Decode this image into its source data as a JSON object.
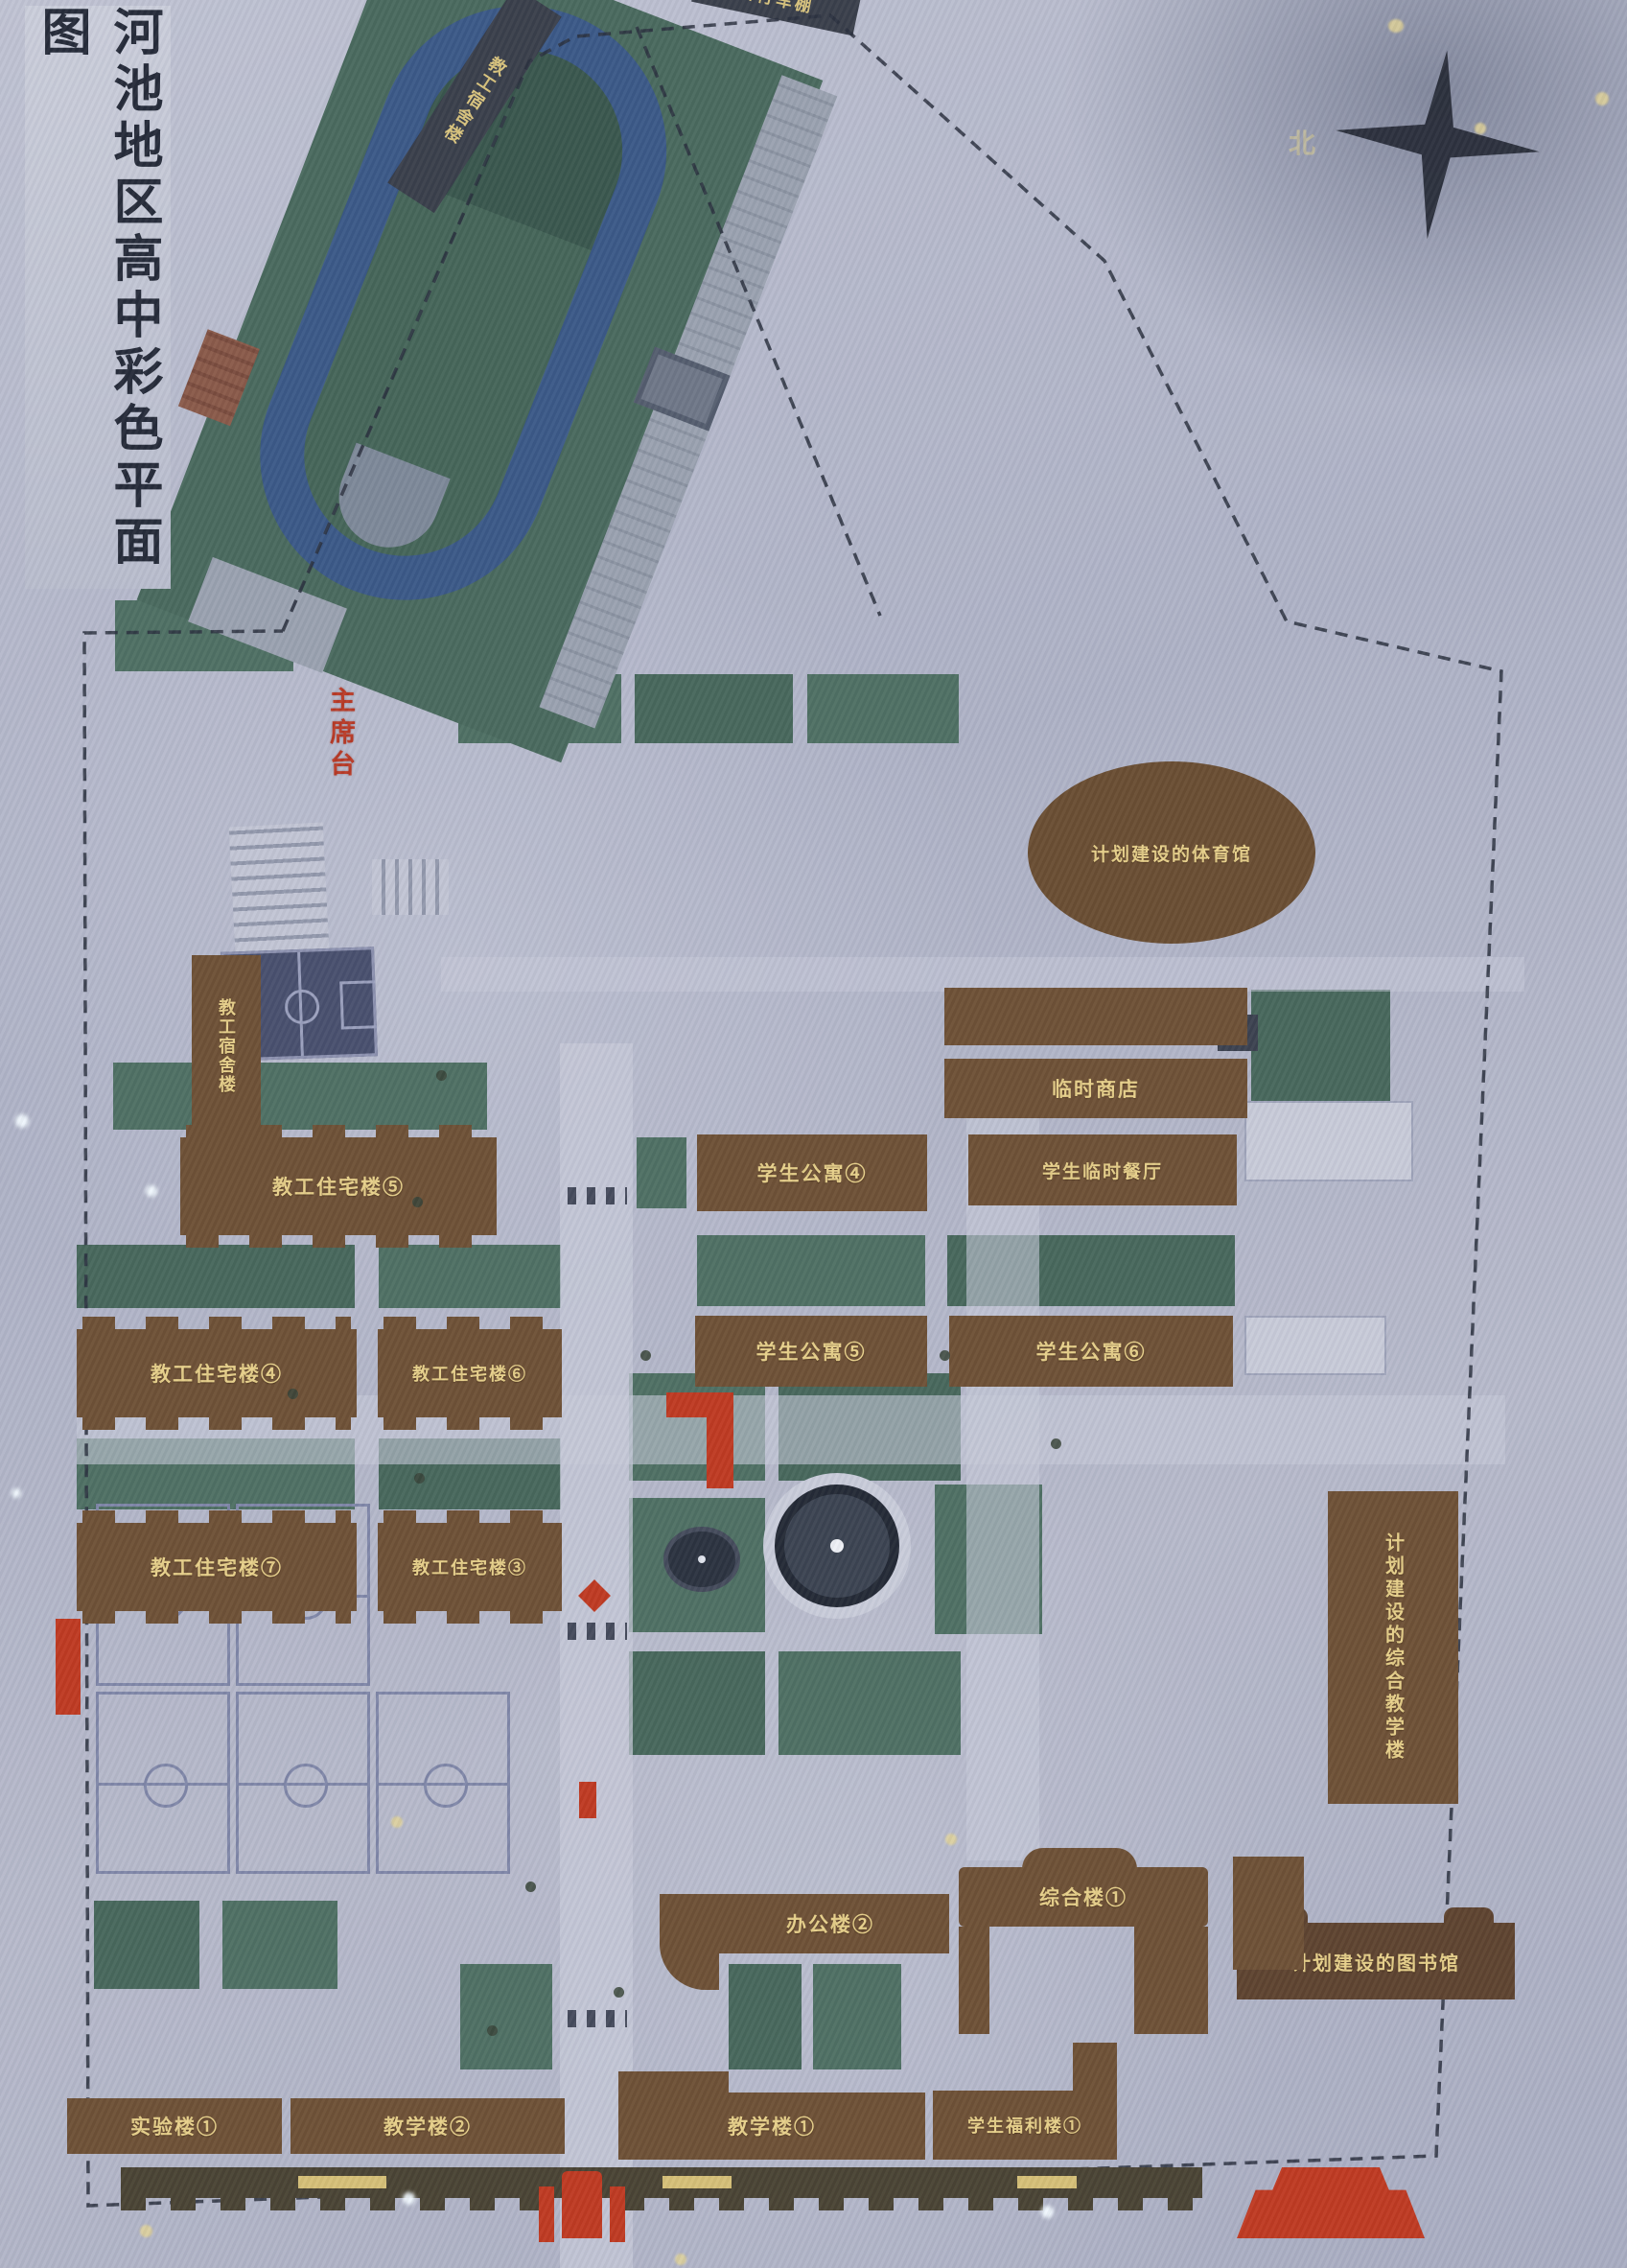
{
  "title": "河池地区高中彩色平面图",
  "compass": {
    "north_label": "北"
  },
  "stadium": {
    "rostrum_label": "主席台"
  },
  "buildings": {
    "staff_dorm": "教工宿舍楼",
    "bike_shed": "自行车棚",
    "staff_res_5": "教工住宅楼⑤",
    "staff_res_4": "教工住宅楼④",
    "staff_res_6": "教工住宅楼⑥",
    "staff_res_7": "教工住宅楼⑦",
    "staff_res_3": "教工住宅楼③",
    "temp_shop": "临时商店",
    "stu_apt_4": "学生公寓④",
    "stu_canteen": "学生临时餐厅",
    "stu_apt_5": "学生公寓⑤",
    "stu_apt_6": "学生公寓⑥",
    "planned_gym": "计划建设的体育馆",
    "planned_complex": "计划建设的综合教学楼",
    "planned_library": "计划建设的图书馆",
    "complex_1": "综合楼①",
    "office_2": "办公楼②",
    "teaching_1": "教学楼①",
    "welfare_1": "学生福利楼①",
    "lab_1": "实验楼①",
    "teaching_2": "教学楼②"
  }
}
